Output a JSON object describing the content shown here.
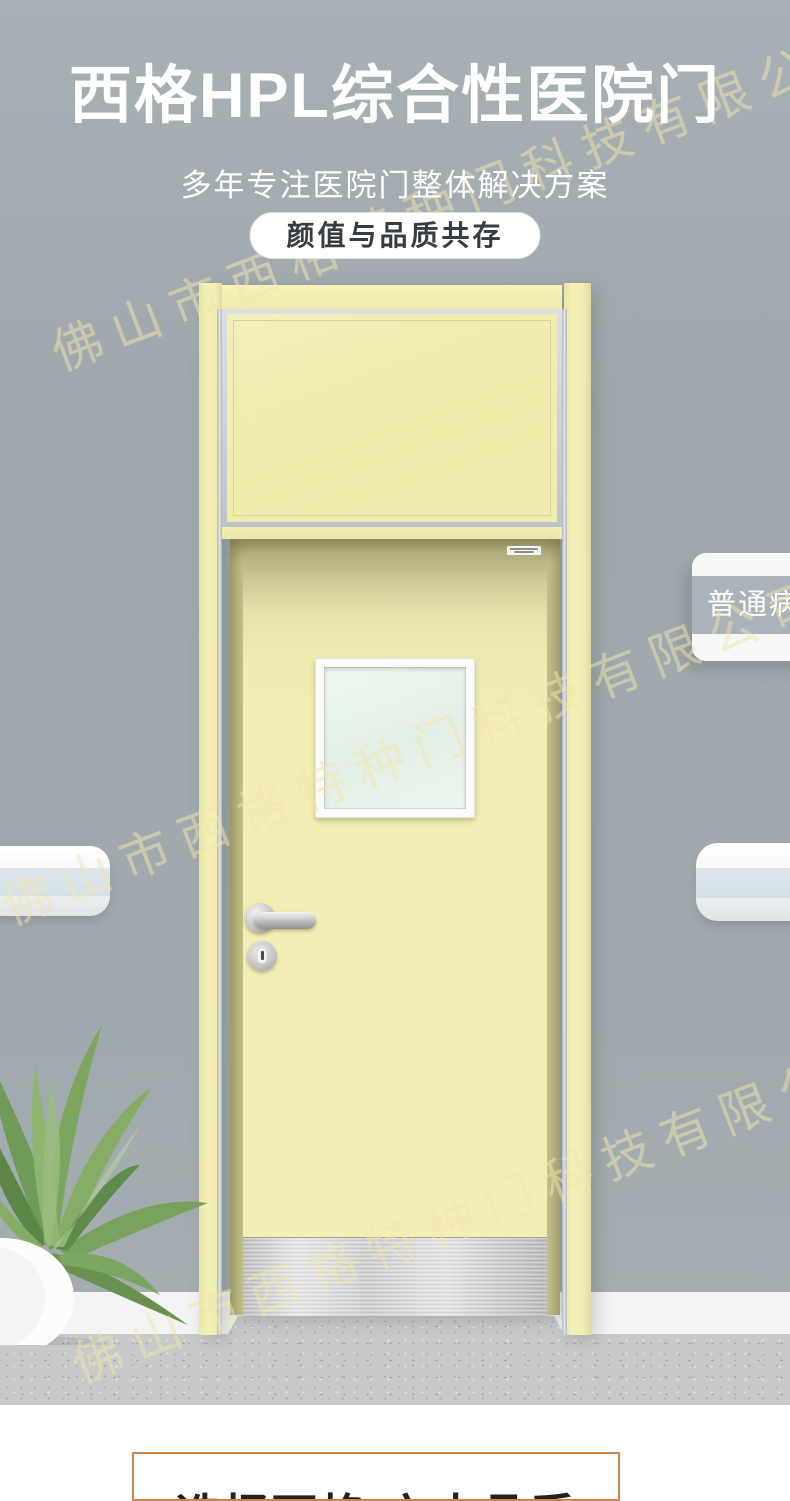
{
  "watermark": {
    "text": "佛山市西格特种门科技有限公司"
  },
  "header": {
    "title": "西格HPL综合性医院门",
    "subtitle": "多年专注医院门整体解决方案",
    "badge_label": "颜值与品质共存"
  },
  "scene": {
    "door_sign_label": "普通病房"
  },
  "next_section": {
    "title": "选择西格·六大品质"
  },
  "colors": {
    "wall_gray": "#A1ABAF",
    "door_yellow": "#F2EEB2",
    "sign_band_gray": "#A9B3B9",
    "accent_orange": "#C9854A",
    "glass_green": "#E9F5EE"
  }
}
